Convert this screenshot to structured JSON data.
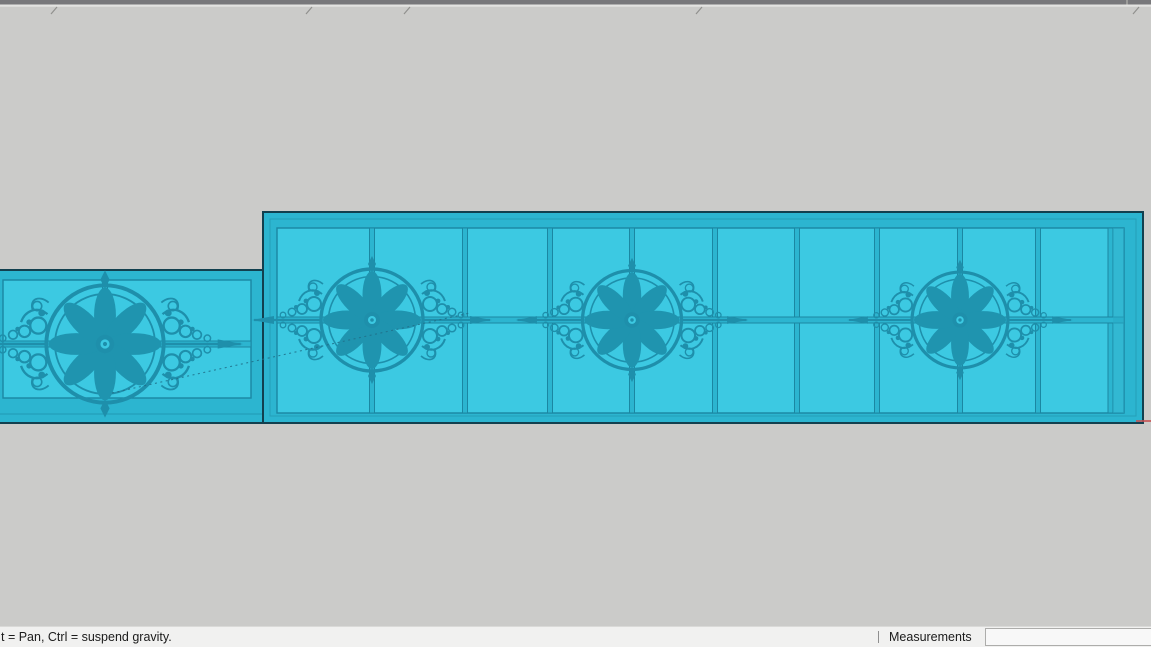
{
  "app": {
    "type": "3d-modeling-viewport",
    "selected_object": "decorative railing panels with rosette medallions",
    "rosette_count": 4
  },
  "colors": {
    "viewport_background": "#cbcbc9",
    "selection_fill": "#3cc9e2",
    "selection_frame": "#2cb5d0",
    "selection_edge_dark": "#12404f",
    "grid_line": "#1b87a2",
    "ornament": "#1e8fab",
    "top_strip": "#78787b",
    "axis_red": "#c75050",
    "statusbar_background": "#f1f1f0"
  },
  "status_bar": {
    "hint_text": "t = Pan, Ctrl = suspend gravity.",
    "measurements_label": "Measurements",
    "measurements_value": "",
    "measurements_placeholder": ""
  }
}
